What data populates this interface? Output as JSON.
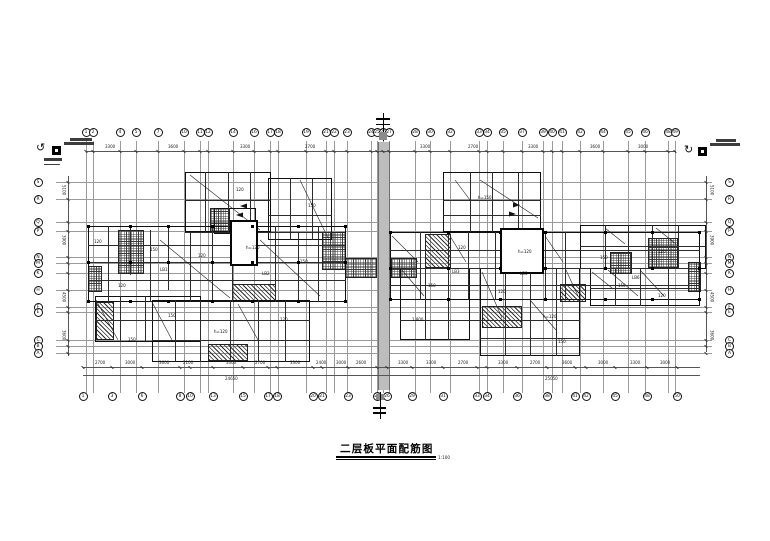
{
  "title": {
    "text": "二层板平面配筋图",
    "scale": "1:100"
  },
  "colors": {
    "ink": "#111111",
    "wall": "#101010",
    "grid": "#9a9a9a",
    "joint": "#bdbdbd"
  },
  "axes": {
    "top": [
      [
        "1",
        86
      ],
      [
        "2",
        93
      ],
      [
        "4",
        120
      ],
      [
        "5",
        136
      ],
      [
        "7",
        158
      ],
      [
        "10",
        184
      ],
      [
        "11",
        200
      ],
      [
        "12",
        208
      ],
      [
        "14",
        233
      ],
      [
        "16",
        254
      ],
      [
        "17",
        270
      ],
      [
        "18",
        278
      ],
      [
        "19",
        306
      ],
      [
        "21",
        326
      ],
      [
        "22",
        334
      ],
      [
        "23",
        347
      ],
      [
        "24",
        371
      ],
      [
        "25",
        377
      ],
      [
        "26",
        383
      ],
      [
        "27",
        389
      ],
      [
        "28",
        415
      ],
      [
        "30",
        430
      ],
      [
        "32",
        450
      ],
      [
        "33",
        479
      ],
      [
        "34",
        487
      ],
      [
        "35",
        503
      ],
      [
        "37",
        522
      ],
      [
        "39",
        543
      ],
      [
        "40",
        552
      ],
      [
        "41",
        562
      ],
      [
        "42",
        580
      ],
      [
        "44",
        603
      ],
      [
        "45",
        628
      ],
      [
        "46",
        645
      ],
      [
        "48",
        668
      ],
      [
        "49",
        675
      ]
    ],
    "bottom": [
      [
        "1",
        83
      ],
      [
        "3",
        112
      ],
      [
        "6",
        142
      ],
      [
        "8",
        180
      ],
      [
        "10",
        190
      ],
      [
        "13",
        213
      ],
      [
        "15",
        243
      ],
      [
        "17",
        268
      ],
      [
        "18",
        277
      ],
      [
        "20",
        313
      ],
      [
        "21",
        322
      ],
      [
        "23",
        348
      ],
      [
        "25",
        377
      ],
      [
        "26",
        387
      ],
      [
        "29",
        412
      ],
      [
        "31",
        443
      ],
      [
        "33",
        477
      ],
      [
        "34",
        487
      ],
      [
        "36",
        517
      ],
      [
        "38",
        547
      ],
      [
        "41",
        575
      ],
      [
        "42",
        586
      ],
      [
        "45",
        615
      ],
      [
        "48",
        647
      ],
      [
        "50",
        677
      ]
    ],
    "left": [
      [
        "S",
        182
      ],
      [
        "R",
        199
      ],
      [
        "Q",
        222
      ],
      [
        "P",
        231
      ],
      [
        "N",
        257
      ],
      [
        "M",
        263
      ],
      [
        "K",
        273
      ],
      [
        "H",
        290
      ],
      [
        "F",
        307
      ],
      [
        "E",
        312
      ],
      [
        "C",
        340
      ],
      [
        "B",
        346
      ],
      [
        "A",
        353
      ]
    ],
    "right": [
      [
        "S",
        182
      ],
      [
        "R",
        199
      ],
      [
        "Q",
        222
      ],
      [
        "P",
        231
      ],
      [
        "N",
        257
      ],
      [
        "M",
        263
      ],
      [
        "K",
        273
      ],
      [
        "H",
        290
      ],
      [
        "F",
        307
      ],
      [
        "E",
        312
      ],
      [
        "C",
        340
      ],
      [
        "B",
        346
      ],
      [
        "A",
        353
      ]
    ]
  },
  "plan": {
    "walls": [
      [
        88,
        226,
        258,
        76,
        2
      ],
      [
        185,
        172,
        86,
        60,
        2
      ],
      [
        268,
        178,
        64,
        62,
        2
      ],
      [
        95,
        296,
        106,
        46,
        2
      ],
      [
        152,
        300,
        158,
        62,
        2
      ],
      [
        214,
        208,
        42,
        26,
        2
      ],
      [
        443,
        172,
        98,
        60,
        2
      ],
      [
        390,
        232,
        310,
        68,
        2
      ],
      [
        580,
        225,
        126,
        44,
        2
      ],
      [
        400,
        268,
        70,
        72,
        2
      ],
      [
        480,
        268,
        100,
        88,
        2
      ],
      [
        590,
        268,
        110,
        38,
        2
      ]
    ],
    "shafts": [
      [
        230,
        220,
        28,
        46
      ],
      [
        500,
        228,
        44,
        46
      ]
    ],
    "inner_v": [
      [
        108,
        226,
        302
      ],
      [
        130,
        226,
        275
      ],
      [
        150,
        230,
        302
      ],
      [
        168,
        226,
        290
      ],
      [
        190,
        232,
        302
      ],
      [
        212,
        226,
        302
      ],
      [
        232,
        264,
        302
      ],
      [
        252,
        226,
        264
      ],
      [
        275,
        226,
        302
      ],
      [
        298,
        232,
        302
      ],
      [
        318,
        226,
        302
      ],
      [
        205,
        172,
        232
      ],
      [
        228,
        172,
        232
      ],
      [
        250,
        172,
        232
      ],
      [
        290,
        178,
        240
      ],
      [
        312,
        178,
        240
      ],
      [
        120,
        296,
        342
      ],
      [
        145,
        296,
        342
      ],
      [
        175,
        300,
        362
      ],
      [
        200,
        300,
        362
      ],
      [
        230,
        300,
        362
      ],
      [
        258,
        300,
        362
      ],
      [
        285,
        300,
        362
      ],
      [
        420,
        232,
        300
      ],
      [
        448,
        232,
        300
      ],
      [
        468,
        232,
        300
      ],
      [
        495,
        232,
        300
      ],
      [
        545,
        232,
        300
      ],
      [
        565,
        232,
        300
      ],
      [
        605,
        225,
        269
      ],
      [
        628,
        225,
        269
      ],
      [
        652,
        225,
        269
      ],
      [
        678,
        225,
        269
      ],
      [
        470,
        172,
        232
      ],
      [
        492,
        172,
        232
      ],
      [
        518,
        172,
        232
      ],
      [
        425,
        268,
        340
      ],
      [
        448,
        268,
        340
      ],
      [
        505,
        268,
        356
      ],
      [
        530,
        268,
        356
      ],
      [
        556,
        268,
        356
      ],
      [
        615,
        268,
        306
      ],
      [
        640,
        268,
        306
      ],
      [
        668,
        268,
        306
      ]
    ],
    "inner_h": [
      [
        245,
        88,
        346
      ],
      [
        262,
        88,
        346
      ],
      [
        280,
        88,
        346
      ],
      [
        232,
        185,
        332
      ],
      [
        200,
        185,
        271
      ],
      [
        215,
        268,
        332
      ],
      [
        320,
        95,
        310
      ],
      [
        340,
        152,
        310
      ],
      [
        200,
        443,
        541
      ],
      [
        215,
        443,
        541
      ],
      [
        250,
        390,
        700
      ],
      [
        268,
        390,
        700
      ],
      [
        285,
        390,
        700
      ],
      [
        246,
        580,
        706
      ],
      [
        320,
        400,
        580
      ],
      [
        338,
        480,
        580
      ],
      [
        288,
        590,
        700
      ]
    ],
    "hatches": [
      [
        118,
        230,
        26,
        44,
        "grid"
      ],
      [
        88,
        266,
        14,
        26,
        "grid"
      ],
      [
        322,
        232,
        24,
        38,
        "grid"
      ],
      [
        345,
        258,
        32,
        20,
        "grid"
      ],
      [
        391,
        258,
        26,
        20,
        "grid"
      ],
      [
        648,
        238,
        30,
        30,
        "grid"
      ],
      [
        610,
        252,
        22,
        22,
        "grid"
      ],
      [
        688,
        262,
        13,
        30,
        "grid"
      ],
      [
        210,
        208,
        20,
        24,
        "grid"
      ],
      [
        232,
        284,
        44,
        18,
        "diag"
      ],
      [
        208,
        344,
        40,
        17,
        "diag"
      ],
      [
        425,
        234,
        26,
        34,
        "diag"
      ],
      [
        560,
        284,
        26,
        18,
        "diag"
      ],
      [
        482,
        306,
        40,
        22,
        "diag"
      ],
      [
        96,
        302,
        18,
        38,
        "diag"
      ],
      [
        378,
        142,
        12,
        248,
        "joint"
      ]
    ],
    "diagonals": [
      [
        392,
        236,
        418,
        262
      ],
      [
        450,
        236,
        466,
        262
      ],
      [
        545,
        236,
        563,
        262
      ],
      [
        566,
        270,
        578,
        296
      ],
      [
        608,
        270,
        638,
        296
      ],
      [
        640,
        270,
        664,
        296
      ],
      [
        402,
        270,
        424,
        296
      ],
      [
        482,
        272,
        502,
        318
      ],
      [
        530,
        300,
        556,
        330
      ],
      [
        592,
        272,
        612,
        288
      ],
      [
        96,
        300,
        118,
        340
      ],
      [
        152,
        302,
        172,
        340
      ],
      [
        160,
        240,
        230,
        298
      ],
      [
        260,
        240,
        320,
        296
      ],
      [
        238,
        304,
        258,
        340
      ],
      [
        480,
        180,
        538,
        218
      ],
      [
        455,
        180,
        470,
        200
      ],
      [
        605,
        228,
        625,
        244
      ],
      [
        656,
        228,
        676,
        244
      ],
      [
        300,
        180,
        328,
        238
      ],
      [
        190,
        175,
        260,
        230
      ]
    ],
    "arrows": [
      [
        520,
        205,
        "r"
      ],
      [
        516,
        214,
        "r"
      ],
      [
        240,
        206,
        "l"
      ],
      [
        236,
        215,
        "l"
      ]
    ],
    "columns": {
      "left": {
        "xs": [
          88,
          130,
          168,
          212,
          252,
          298,
          345
        ],
        "ys": [
          226,
          262,
          301
        ]
      },
      "right": {
        "xs": [
          390,
          448,
          500,
          545,
          605,
          652,
          699
        ],
        "ys": [
          232,
          268,
          299
        ]
      }
    },
    "annotations": [
      [
        "150",
        150,
        248
      ],
      [
        "120",
        198,
        254
      ],
      [
        "h=120",
        246,
        246
      ],
      [
        "150",
        300,
        260
      ],
      [
        "120",
        118,
        284
      ],
      [
        "150",
        168,
        314
      ],
      [
        "h=120",
        214,
        330
      ],
      [
        "120",
        280,
        318
      ],
      [
        "120",
        458,
        246
      ],
      [
        "h=120",
        518,
        250
      ],
      [
        "150",
        600,
        256
      ],
      [
        "120",
        658,
        250
      ],
      [
        "150",
        428,
        284
      ],
      [
        "120",
        498,
        290
      ],
      [
        "h=120",
        543,
        315
      ],
      [
        "150",
        618,
        284
      ],
      [
        "120",
        94,
        240
      ],
      [
        "150",
        308,
        204
      ],
      [
        "h=150",
        478,
        196
      ],
      [
        "120",
        236,
        188
      ],
      [
        "1.800",
        412,
        318
      ],
      [
        "150",
        558,
        340
      ],
      [
        "120",
        658,
        294
      ],
      [
        "150",
        128,
        338
      ],
      [
        "LB1",
        160,
        268
      ],
      [
        "LB2",
        262,
        272
      ],
      [
        "LB3",
        452,
        270
      ],
      [
        "LB5",
        520,
        272
      ],
      [
        "LB6",
        632,
        276
      ]
    ],
    "dims": {
      "bottom": [
        [
          "2700",
          95
        ],
        [
          "3000",
          125
        ],
        [
          "3600",
          159
        ],
        [
          "2100",
          183
        ],
        [
          "3300",
          226
        ],
        [
          "2700",
          255
        ],
        [
          "3300",
          290
        ],
        [
          "2400",
          316
        ],
        [
          "3000",
          336
        ],
        [
          "2600",
          356
        ],
        [
          "3300",
          398
        ],
        [
          "3300",
          426
        ],
        [
          "2700",
          458
        ],
        [
          "3300",
          498
        ],
        [
          "2700",
          530
        ],
        [
          "3600",
          562
        ],
        [
          "3000",
          598
        ],
        [
          "3300",
          630
        ],
        [
          "3000",
          660
        ]
      ],
      "top": [
        [
          "3300",
          105
        ],
        [
          "3600",
          168
        ],
        [
          "3300",
          240
        ],
        [
          "2700",
          305
        ],
        [
          "3300",
          420
        ],
        [
          "2700",
          468
        ],
        [
          "3300",
          528
        ],
        [
          "3600",
          590
        ],
        [
          "3000",
          638
        ]
      ],
      "overall": [
        [
          "24650",
          225
        ],
        [
          "25050",
          545
        ]
      ],
      "left": [
        [
          "5100",
          185
        ],
        [
          "3900",
          235
        ],
        [
          "4500",
          292
        ],
        [
          "3600",
          330
        ]
      ],
      "right": [
        [
          "5100",
          185
        ],
        [
          "3900",
          235
        ],
        [
          "4500",
          292
        ],
        [
          "3600",
          330
        ]
      ]
    }
  },
  "symbols": {
    "corner_left": "detail-callout-with-rotation-arrow",
    "corner_right": "detail-callout-with-rotation-arrow",
    "section_top": "section-cut-marker",
    "section_bottom": "section-cut-marker"
  }
}
